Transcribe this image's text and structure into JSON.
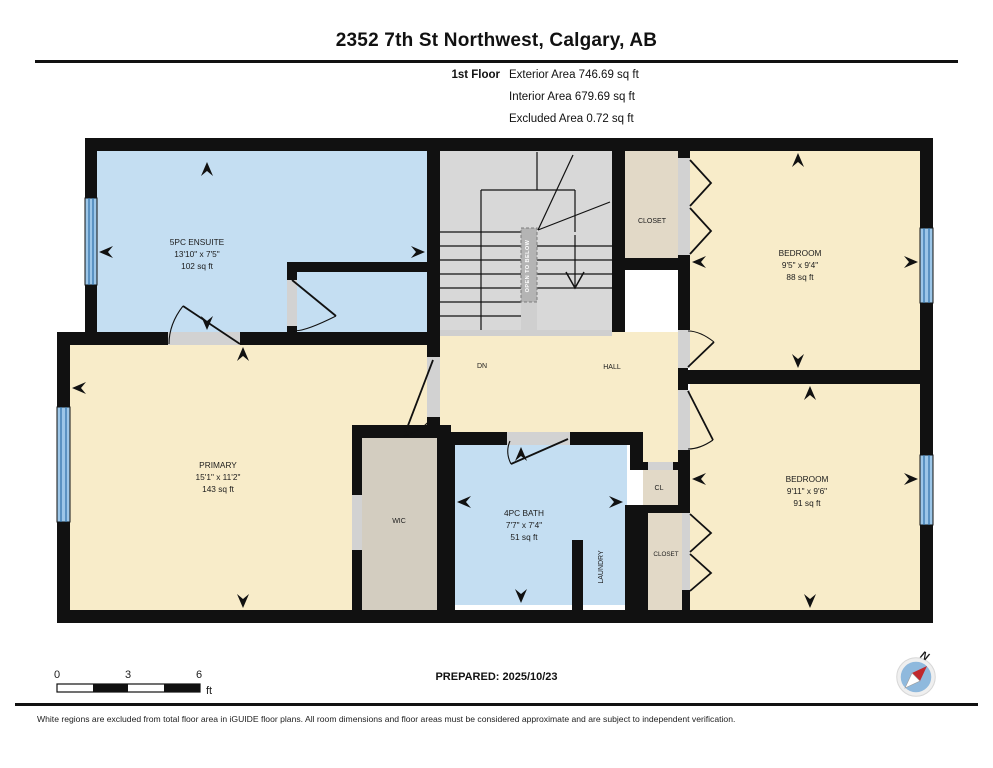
{
  "header": {
    "title": "2352 7th St Northwest, Calgary, AB",
    "floor_label": "1st Floor",
    "areas": [
      "Exterior Area 746.69 sq ft",
      "Interior Area 679.69 sq ft",
      "Excluded Area 0.72 sq ft"
    ]
  },
  "plan": {
    "rooms": {
      "ensuite": {
        "name": "5PC ENSUITE",
        "dims": "13'10\" x 7'5\"",
        "area": "102 sq ft"
      },
      "primary": {
        "name": "PRIMARY",
        "dims": "15'1\" x 11'2\"",
        "area": "143 sq ft"
      },
      "bedroom_top": {
        "name": "BEDROOM",
        "dims": "9'5\" x 9'4\"",
        "area": "88 sq ft"
      },
      "bedroom_bottom": {
        "name": "BEDROOM",
        "dims": "9'11\" x 9'6\"",
        "area": "91 sq ft"
      },
      "bath": {
        "name": "4PC BATH",
        "dims": "7'7\" x 7'4\"",
        "area": "51 sq ft"
      },
      "wic": {
        "name": "WIC"
      },
      "hall": {
        "name": "HALL"
      },
      "closet_top": {
        "name": "CLOSET"
      },
      "closet_bottom": {
        "name": "CLOSET"
      },
      "cl": {
        "name": "CL"
      },
      "laundry": {
        "name": "LAUNDRY"
      }
    },
    "annotations": {
      "dn": "DN",
      "open_to_below": "OPEN TO BELOW"
    }
  },
  "scale_bar": {
    "ticks": [
      "0",
      "3",
      "6"
    ],
    "unit": "ft"
  },
  "compass": {
    "north_label": "N"
  },
  "footer": {
    "prepared": "PREPARED: 2025/10/23",
    "disclaimer": "White regions are excluded from total floor area in iGUIDE floor plans. All room dimensions and floor areas must be considered approximate and are subject to independent verification."
  },
  "colors": {
    "room_cream": "#f8ecc9",
    "room_blue": "#c4def2",
    "stairs_gray": "#d8d8d8",
    "closet_beige": "#e2d9c7",
    "wic_gray": "#d3cdc0",
    "wall_black": "#111111",
    "window_blue": "#9cc6e8",
    "window_line": "#2f6fa8",
    "compass_red": "#c0282d",
    "compass_disc": "#8fb9dd"
  }
}
